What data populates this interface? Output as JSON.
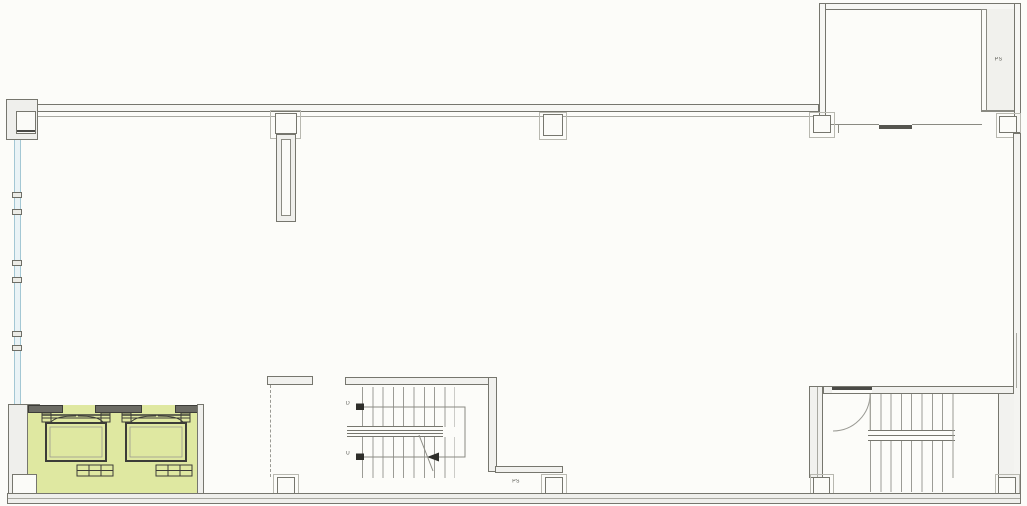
{
  "labels": {
    "ps_wing": "PS",
    "ps_bottom": "PS",
    "stair_d": "D",
    "stair_u": "U"
  },
  "colors": {
    "background": "#fcfcf9",
    "wall_fill": "#f1f1ee",
    "wall_line": "#76766e",
    "dark_line": "#3c3c38",
    "highlight_yellow": "#dfe8a1",
    "curtain_blue": "#a3c7d4",
    "tread_line": "#9c9c96"
  },
  "features": {
    "elevator_cars": 2,
    "stairs": 2,
    "ps_shafts": 2,
    "highlighted_area": "elevator bank (2 cars), lower left, highlighted yellow-green"
  }
}
